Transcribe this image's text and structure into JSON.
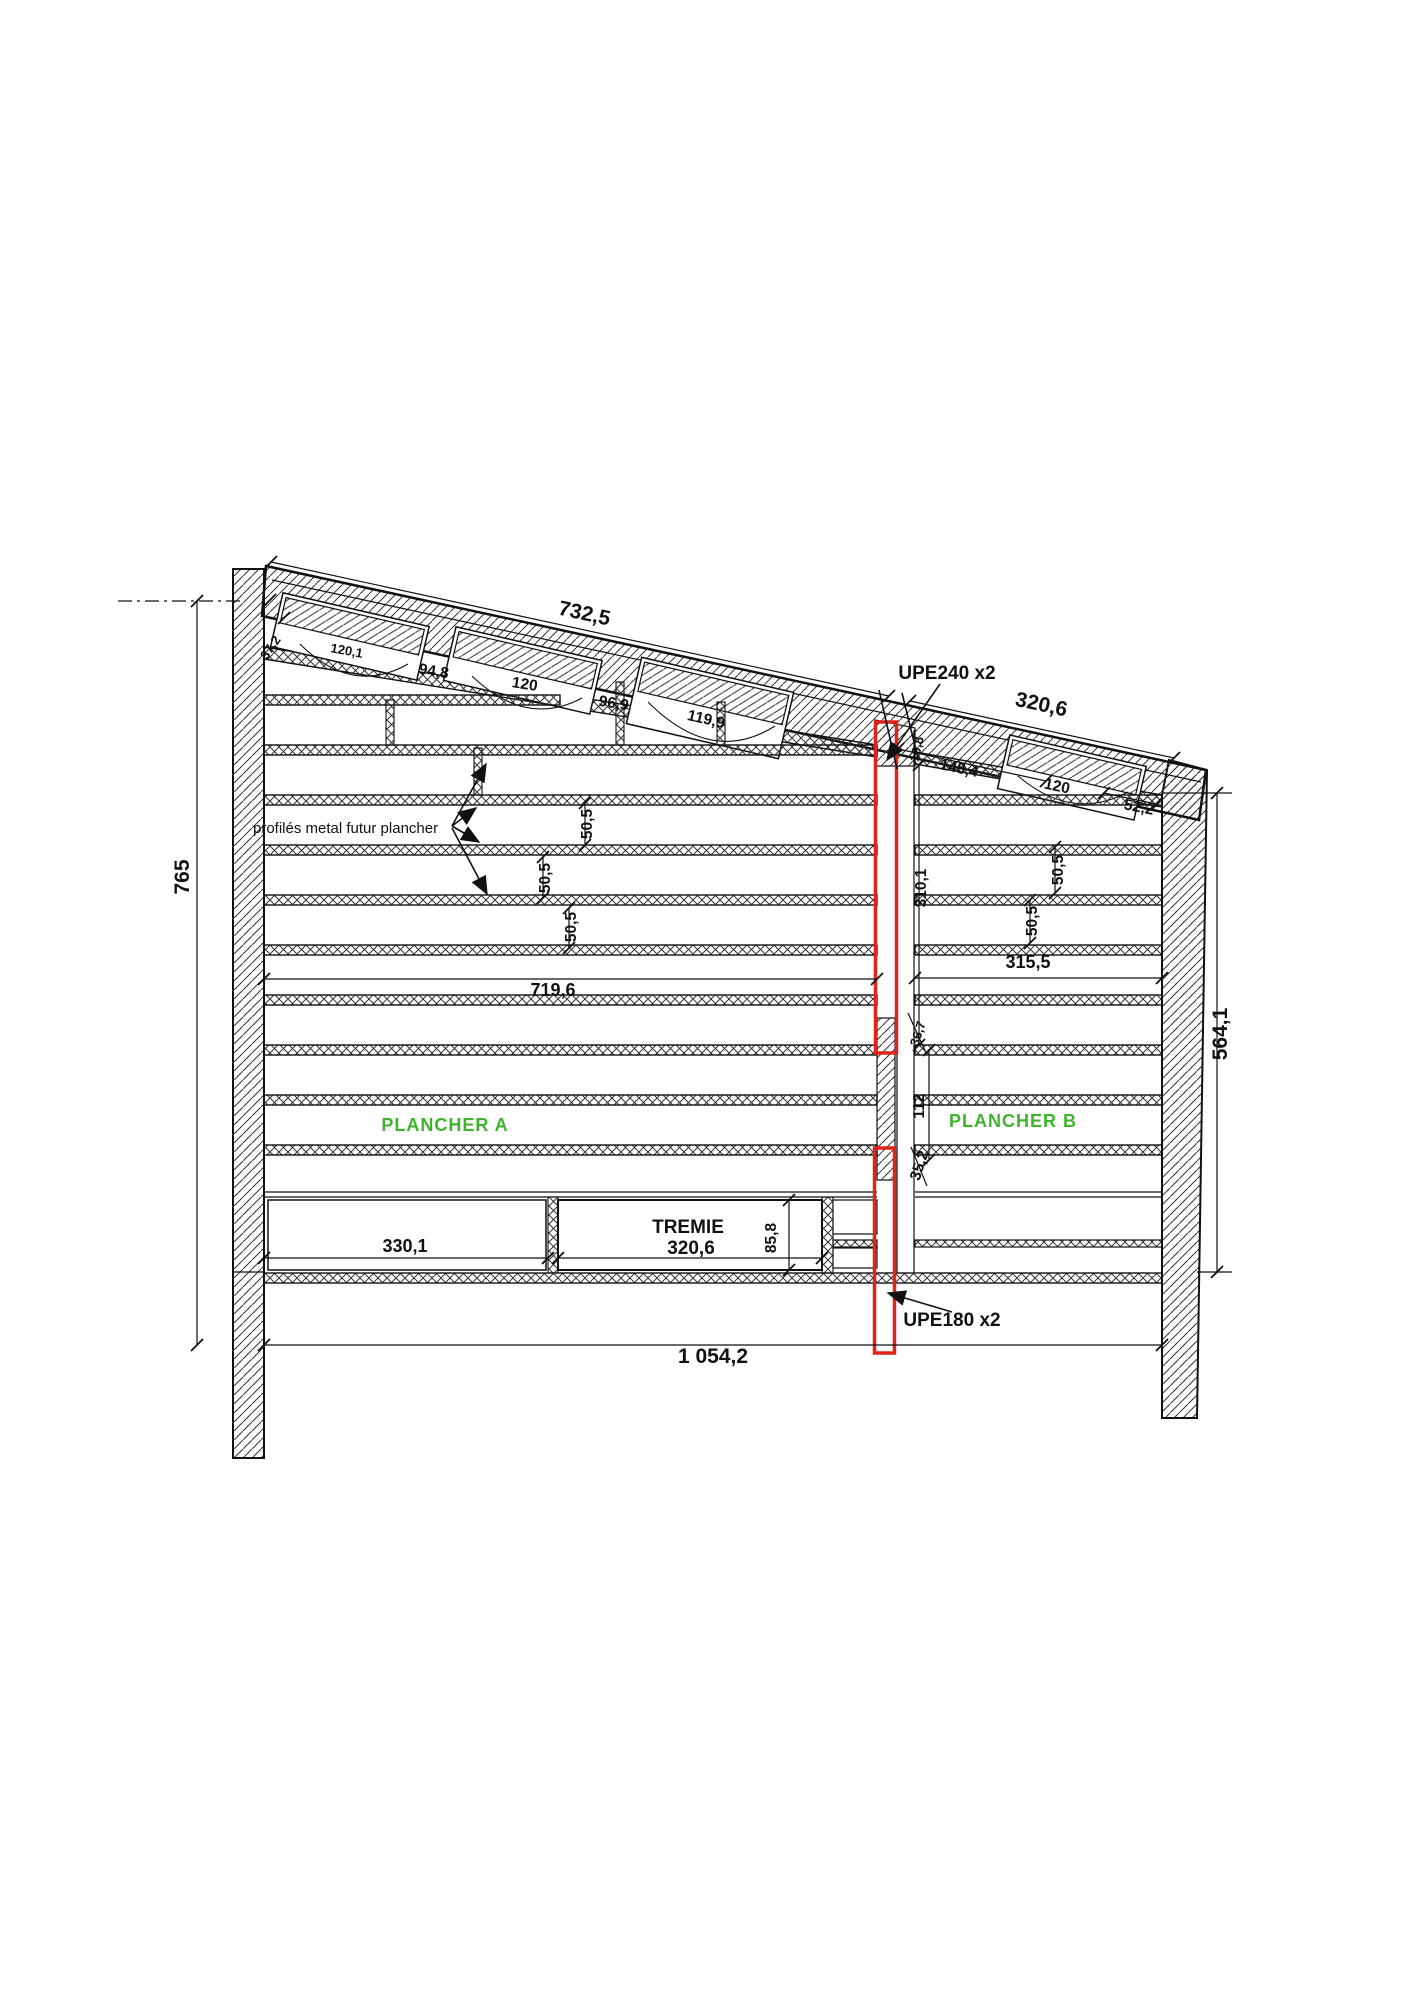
{
  "drawing": {
    "description": "Structural section drawing of a building with sloped roof, two masonry walls, steel floor joists and reinforcement UPE profiles highlighted in red",
    "colors": {
      "line": "#111111",
      "highlight_red": "#e2231a",
      "annotation_green": "#3db42c",
      "background": "#ffffff"
    },
    "labels": {
      "dim_roof_left": "732,5",
      "dim_roof_left_start": "37,2",
      "dim_purlin_1": "120,1",
      "dim_purlin_gap_1": "94,8",
      "dim_purlin_2": "120",
      "dim_purlin_gap_2": "96,9",
      "dim_purlin_3": "119,9",
      "upe240": "UPE240 x2",
      "dim_upe_offset": "19,8",
      "dim_right_1": "148,4",
      "dim_right_purlin": "120",
      "dim_roof_right": "320,6",
      "dim_roof_right_end": "52,2",
      "dim_wall_left_height": "765",
      "dim_spacing": "50,5",
      "note_profiles": "profilés metal futur plancher",
      "dim_span_left": "719,6",
      "dim_span_right": "315,5",
      "dim_column_height": "310,1",
      "dim_col_1": "36,7",
      "dim_col_2": "112",
      "dim_col_3": "35,2",
      "dim_wall_right_height": "564,1",
      "plancher_a": "PLANCHER A",
      "plancher_b": "PLANCHER B",
      "dim_opening_left": "330,1",
      "tremie_title": "TREMIE",
      "tremie_width": "320,6",
      "tremie_height": "85,8",
      "dim_total": "1 054,2",
      "upe180": "UPE180 x2"
    }
  }
}
